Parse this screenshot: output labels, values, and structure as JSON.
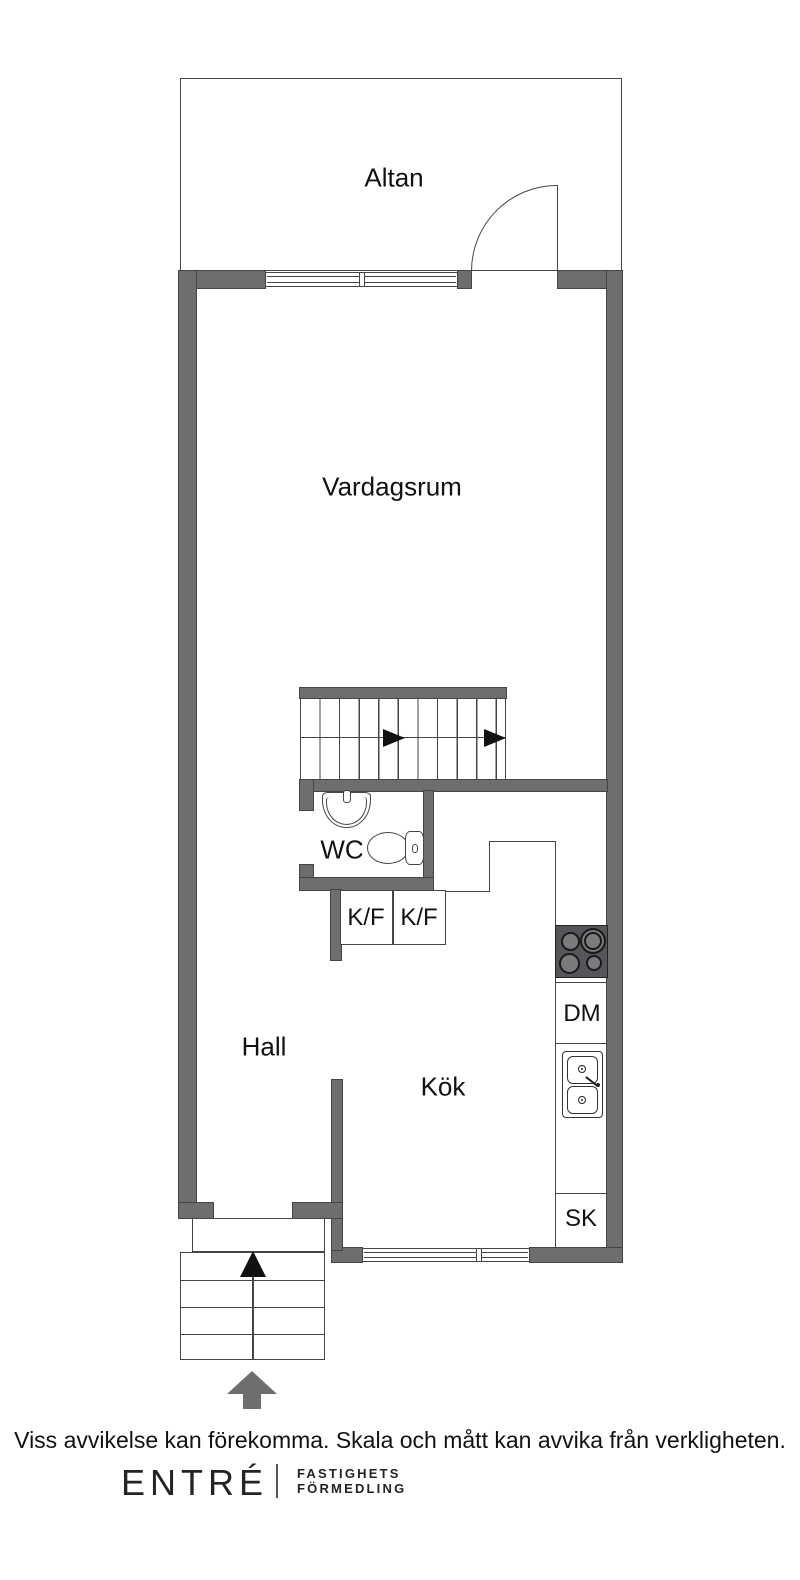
{
  "floorplan": {
    "room_labels": {
      "altan": "Altan",
      "vardagsrum": "Vardagsrum",
      "wc": "WC",
      "hall": "Hall",
      "kok": "Kök"
    },
    "appliance_labels": {
      "kf_left": "K/F",
      "kf_right": "K/F",
      "dishwasher": "DM",
      "cabinet": "SK"
    }
  },
  "footer": {
    "disclaimer": "Viss avvikelse kan förekomma. Skala och mått kan avvika från verkligheten.",
    "logo": {
      "brand": "ENTRÉ",
      "tagline_line1": "FASTIGHETS",
      "tagline_line2": "FÖRMEDLING"
    }
  },
  "colors": {
    "wall": "#6e6e6e",
    "outline": "#454545",
    "stove": "#55565a",
    "burner": "#7b7b7e",
    "ink": "#111111",
    "logo_ink": "#232329"
  }
}
